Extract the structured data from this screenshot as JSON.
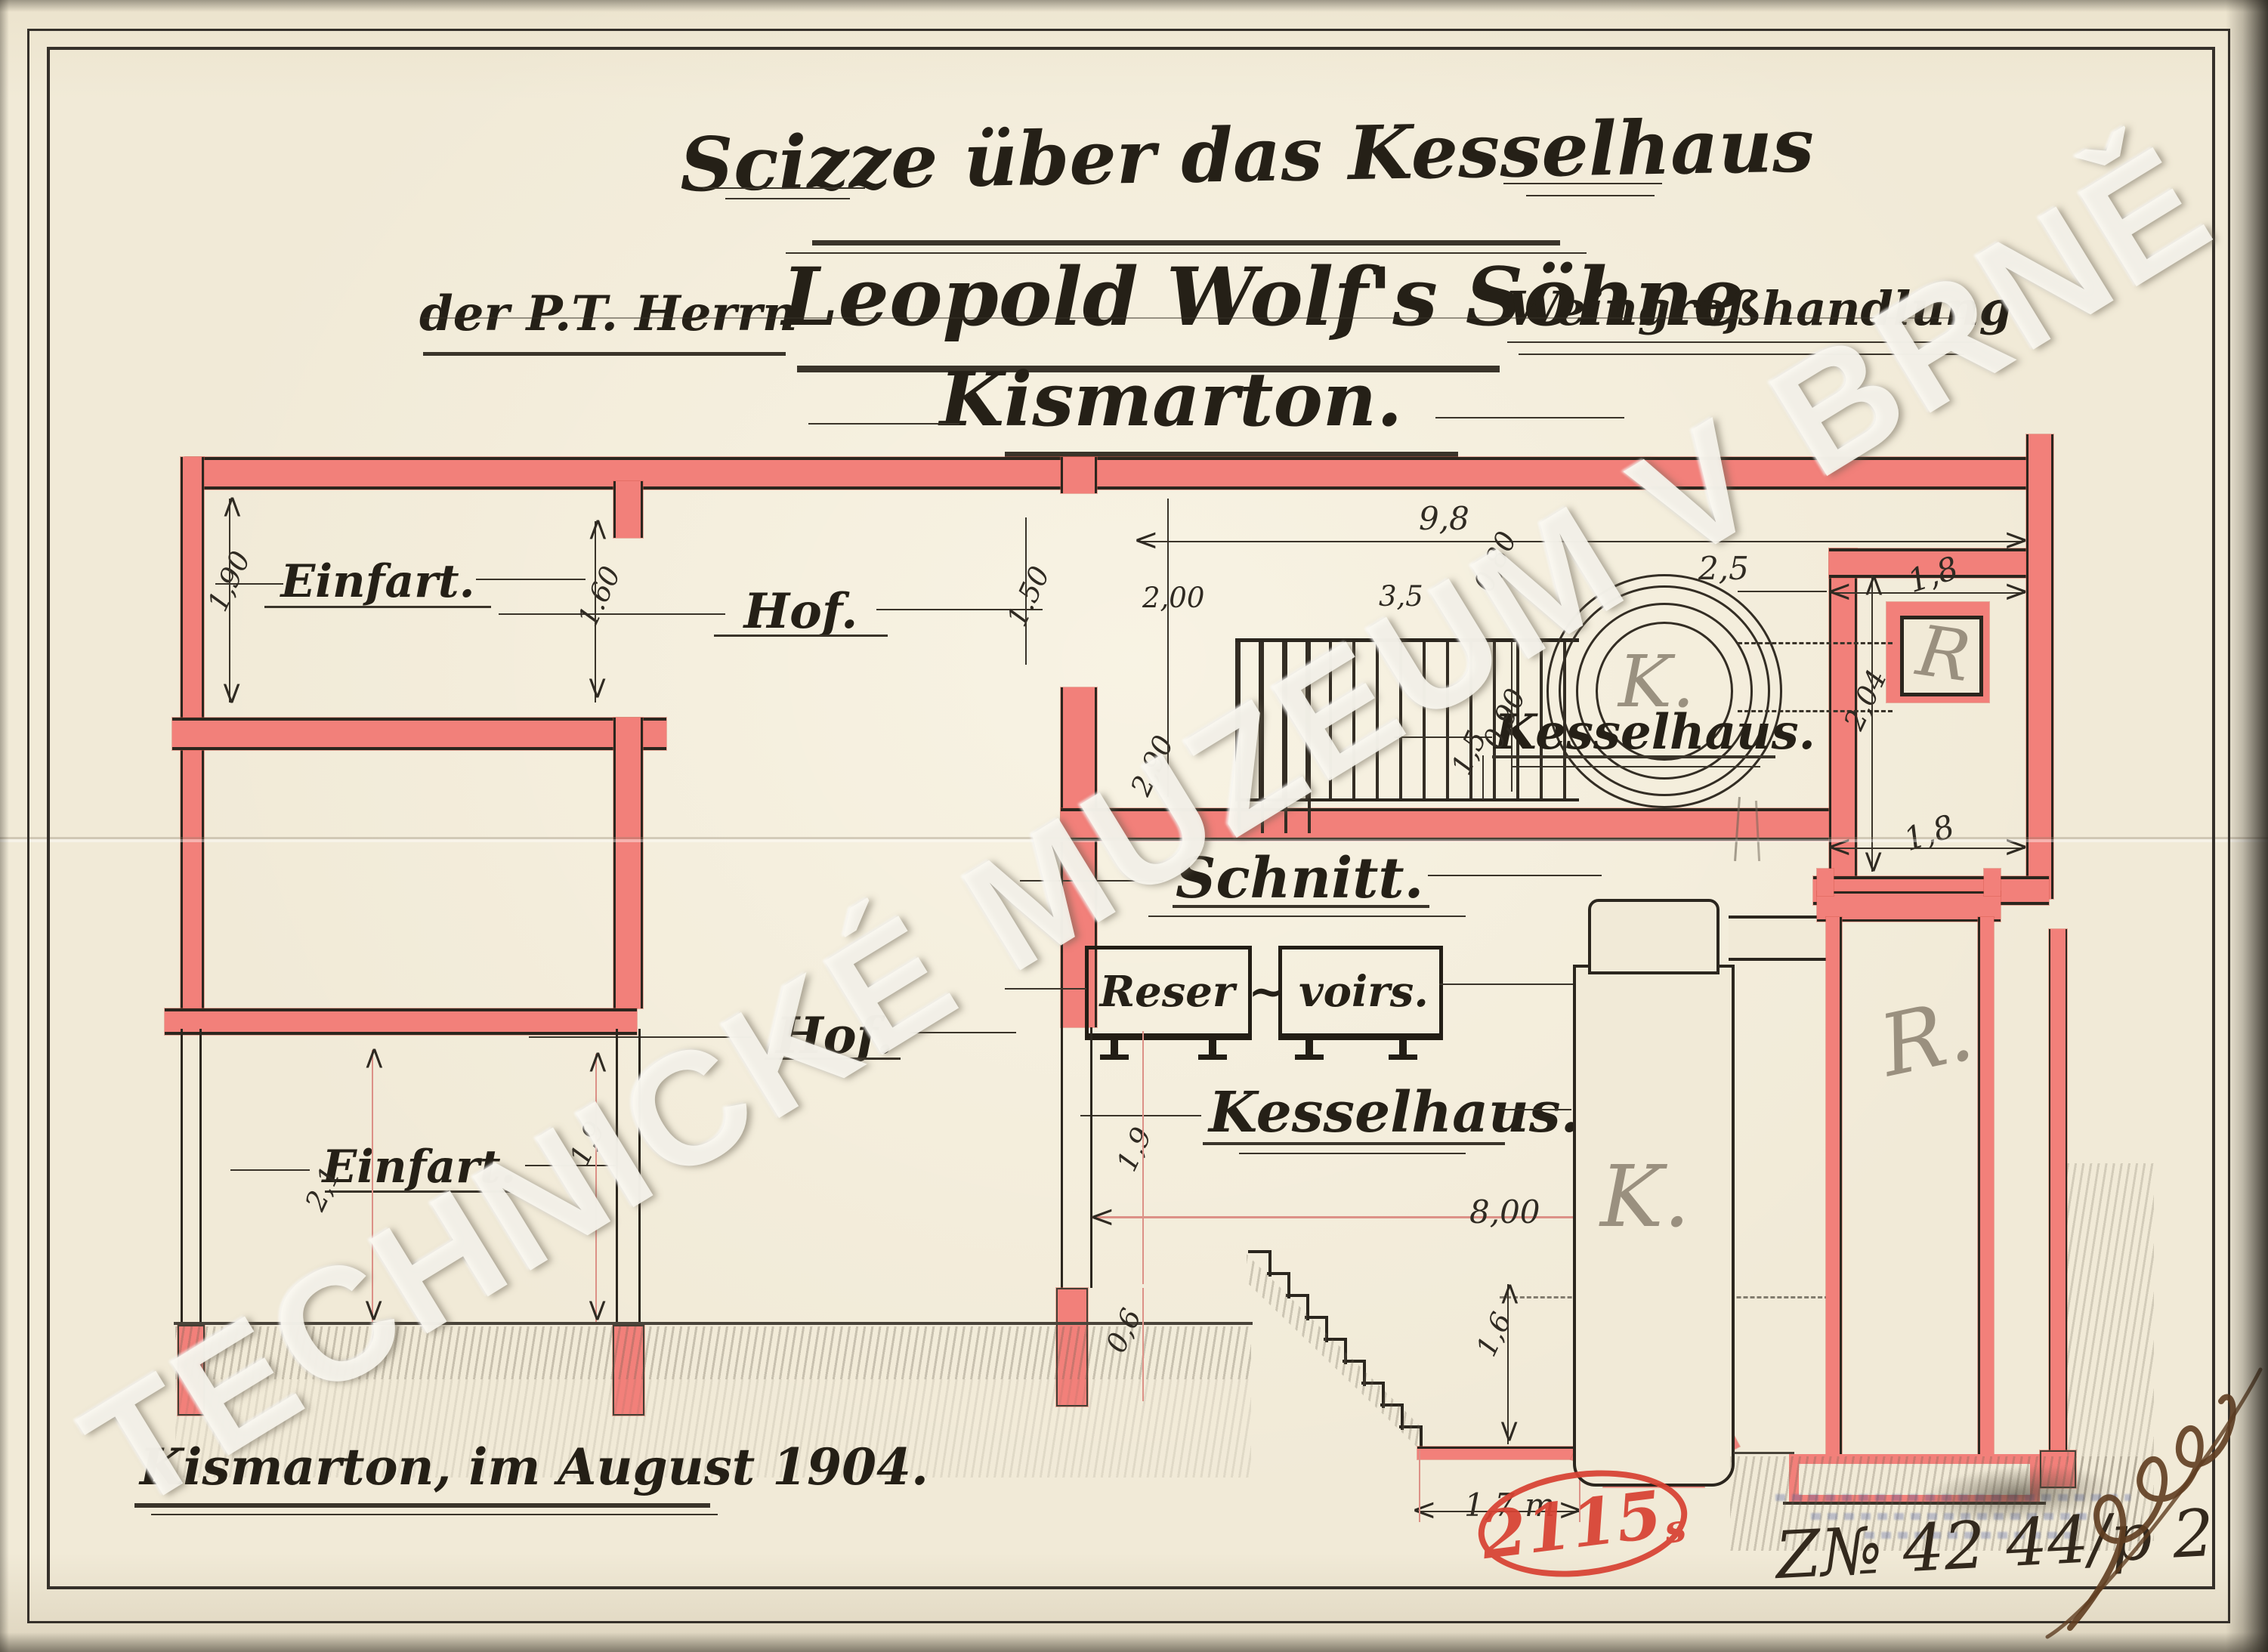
{
  "watermark": {
    "text": "TECHNICKÉ MUZEUM V BRNĚ"
  },
  "title": {
    "line1": "Scizze über das Kesselhaus",
    "line2_prefix": "der P.T. Herrn",
    "line2_main": "Leopold Wolf's Söhne",
    "line2_suffix": "Weingroßhandlung",
    "line3": "Kismarton."
  },
  "plan": {
    "labels": {
      "einfart": "Einfart.",
      "hof": "Hof.",
      "kesselhaus": "Kesselhaus.",
      "boiler": "K.",
      "chimney": "R"
    },
    "dims": {
      "einfart_left": "1,90",
      "einfart_right": "1.60",
      "hof_door": "1.50",
      "kessel_left": "2,00",
      "grate_width": "3,5",
      "total_width": "9,8",
      "passage": "0,80",
      "kessel_depth": "2,90",
      "grate_depth": "0,90",
      "label_offset": "1,5",
      "boiler_gap": "2,5",
      "chimney_top": "1,8",
      "chimney_height": "2,04",
      "chimney_bottom": "1,8"
    }
  },
  "section": {
    "labels": {
      "schnitt": "Schnitt.",
      "reser": "Reser",
      "tilde": "~",
      "voirs": "voirs.",
      "kesselhaus": "Kesselhaus.",
      "hof": "Hof.",
      "einfart": "Einfart.",
      "boiler": "K.",
      "chimney": "R."
    },
    "dims": {
      "einfart_height_left": "2,1",
      "einfart_height_right": "1,9",
      "hof_height": "1,9",
      "foundation": "0,6",
      "room_width": "8,00",
      "pit_depth": "1,6",
      "pit_width": "1,7 m"
    }
  },
  "footer": {
    "place_date": "Kismarton, im August 1904.",
    "stamp_number": "2115",
    "stamp_suffix": "s",
    "inventory_number": "Z№ 42 44/p 2"
  }
}
